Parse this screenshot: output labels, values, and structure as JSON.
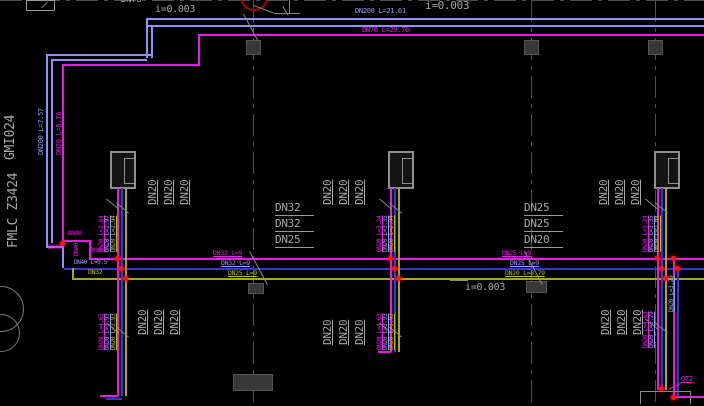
{
  "canvas": {
    "bg": "#000000"
  },
  "colors": {
    "magenta": "#e81ae8",
    "blue_light": "#8f8fff",
    "blue": "#3535d8",
    "yellow": "#a8a818",
    "red": "#ff1414",
    "grid_gray": "#4f4f4f",
    "text_gray": "#a9a9a9"
  },
  "margin_texts": {
    "top": "GMI024",
    "bottom": "FMLC Z3424"
  },
  "top_labels": {
    "dn70": "DN70",
    "slope_left": "i=0.003",
    "blue_main": "DN200 L=21.61",
    "slope_right": "i=0.003",
    "magenta_main": "DN70 L=29.76"
  },
  "left_pipe_labels": {
    "blue": "DN200 L=7.57",
    "magenta": "DN70 L=6.76"
  },
  "junction_labels": {
    "dn40_top": "DN40",
    "dn40_vertical": "DN40",
    "dn40_mid": "DN40",
    "dn40_left": "DN40",
    "blue_branch": "DN40 L=0.5",
    "yellow_branch": "DN32"
  },
  "segment1": {
    "magenta": "DN32 L=9",
    "blue": "DN32 L=9",
    "yellow": "DN25 L=9"
  },
  "segment2": {
    "magenta": "DN25 L=9",
    "blue": "DN25 L=9",
    "yellow": "DN20 L=8.79",
    "slope": "i=0.003"
  },
  "stacks": {
    "mid": [
      "DN32",
      "DN32",
      "DN25"
    ],
    "right": [
      "DN25",
      "DN25",
      "DN20"
    ]
  },
  "groups": {
    "top_left": {
      "dn20": [
        "DN20",
        "DN20",
        "DN20"
      ],
      "risers": [
        "DN20 L=2.84",
        "DN20 L=2.97",
        "DN20 L=2.94"
      ]
    },
    "top_center": {
      "dn20": [
        "DN20",
        "DN20",
        "DN20"
      ],
      "risers": [
        "DN20 L=3.24",
        "DN20 L=3.35",
        "DN20 L=2.94"
      ]
    },
    "top_right": {
      "dn20": [
        "DN20",
        "DN20",
        "DN20"
      ],
      "risers": [
        "DN20 L=3.24",
        "DN20 L=3.35",
        "DN20 L=2.94"
      ]
    },
    "bottom_left": {
      "dn20": [
        "DN20",
        "DN20",
        "DN20"
      ],
      "risers": [
        "DN20 L=4.63",
        "DN20 L=3.93",
        "DN20 L=3.93"
      ]
    },
    "bottom_center": {
      "dn20": [
        "DN20",
        "DN20",
        "DN20"
      ],
      "risers": [
        "DN20 L=4.63",
        "DN20 L=3.93",
        "DN20 L=3.93"
      ]
    },
    "bottom_right": {
      "dn20": [
        "DN20",
        "DN20",
        "DN20"
      ],
      "risers": [
        "DN20 L=4.63",
        "DN20 L=3.29"
      ],
      "edge": "DN20 L=3.29",
      "tag": "QT2"
    }
  }
}
